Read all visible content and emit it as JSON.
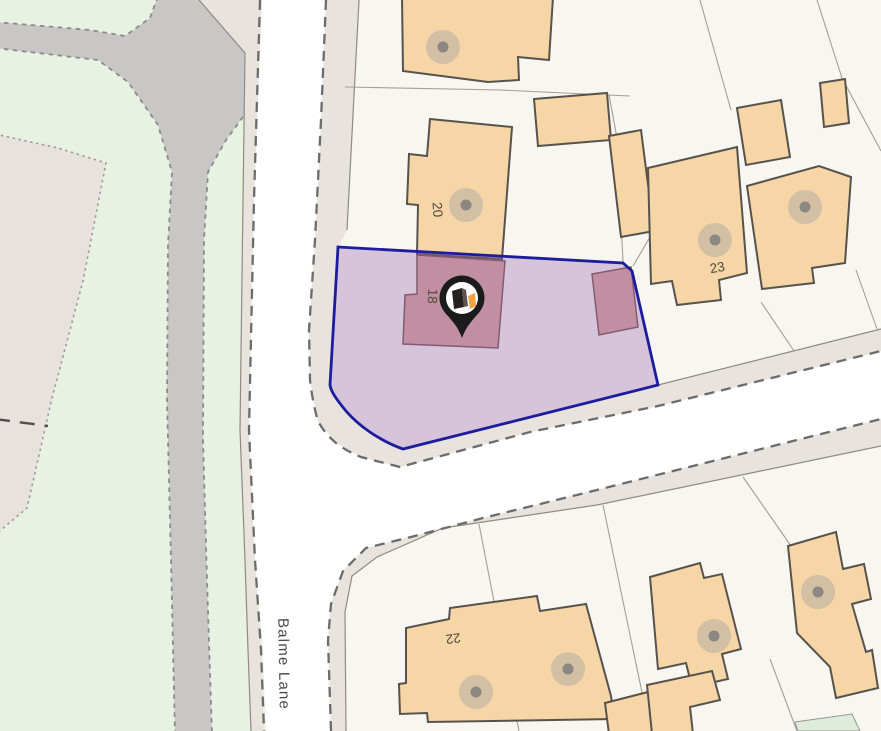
{
  "map": {
    "kind": "property-location-map",
    "street_label": "Balme Lane",
    "labels": {
      "building_20": "20",
      "building_18": "18",
      "building_23": "23",
      "building_22": "22"
    },
    "marker": {
      "icon": "location-pin",
      "logo_colors": {
        "black": "#24211e",
        "orange": "#f2a23c"
      }
    },
    "colors": {
      "parcel_highlight_fill": "#8f5fae",
      "parcel_highlight_border": "#1c1c9c",
      "building_tan": "#f6d5a7",
      "building_outline": "#57534c",
      "building_salmon": "#dca89d",
      "greenspace": "#e7f2e2",
      "path_gray": "#c9c7c6",
      "verge_beige": "#e9e3de",
      "left_area_beige": "#e9e1dc",
      "road_white": "#ffffff",
      "parcel_background": "#f8f6f1"
    }
  }
}
